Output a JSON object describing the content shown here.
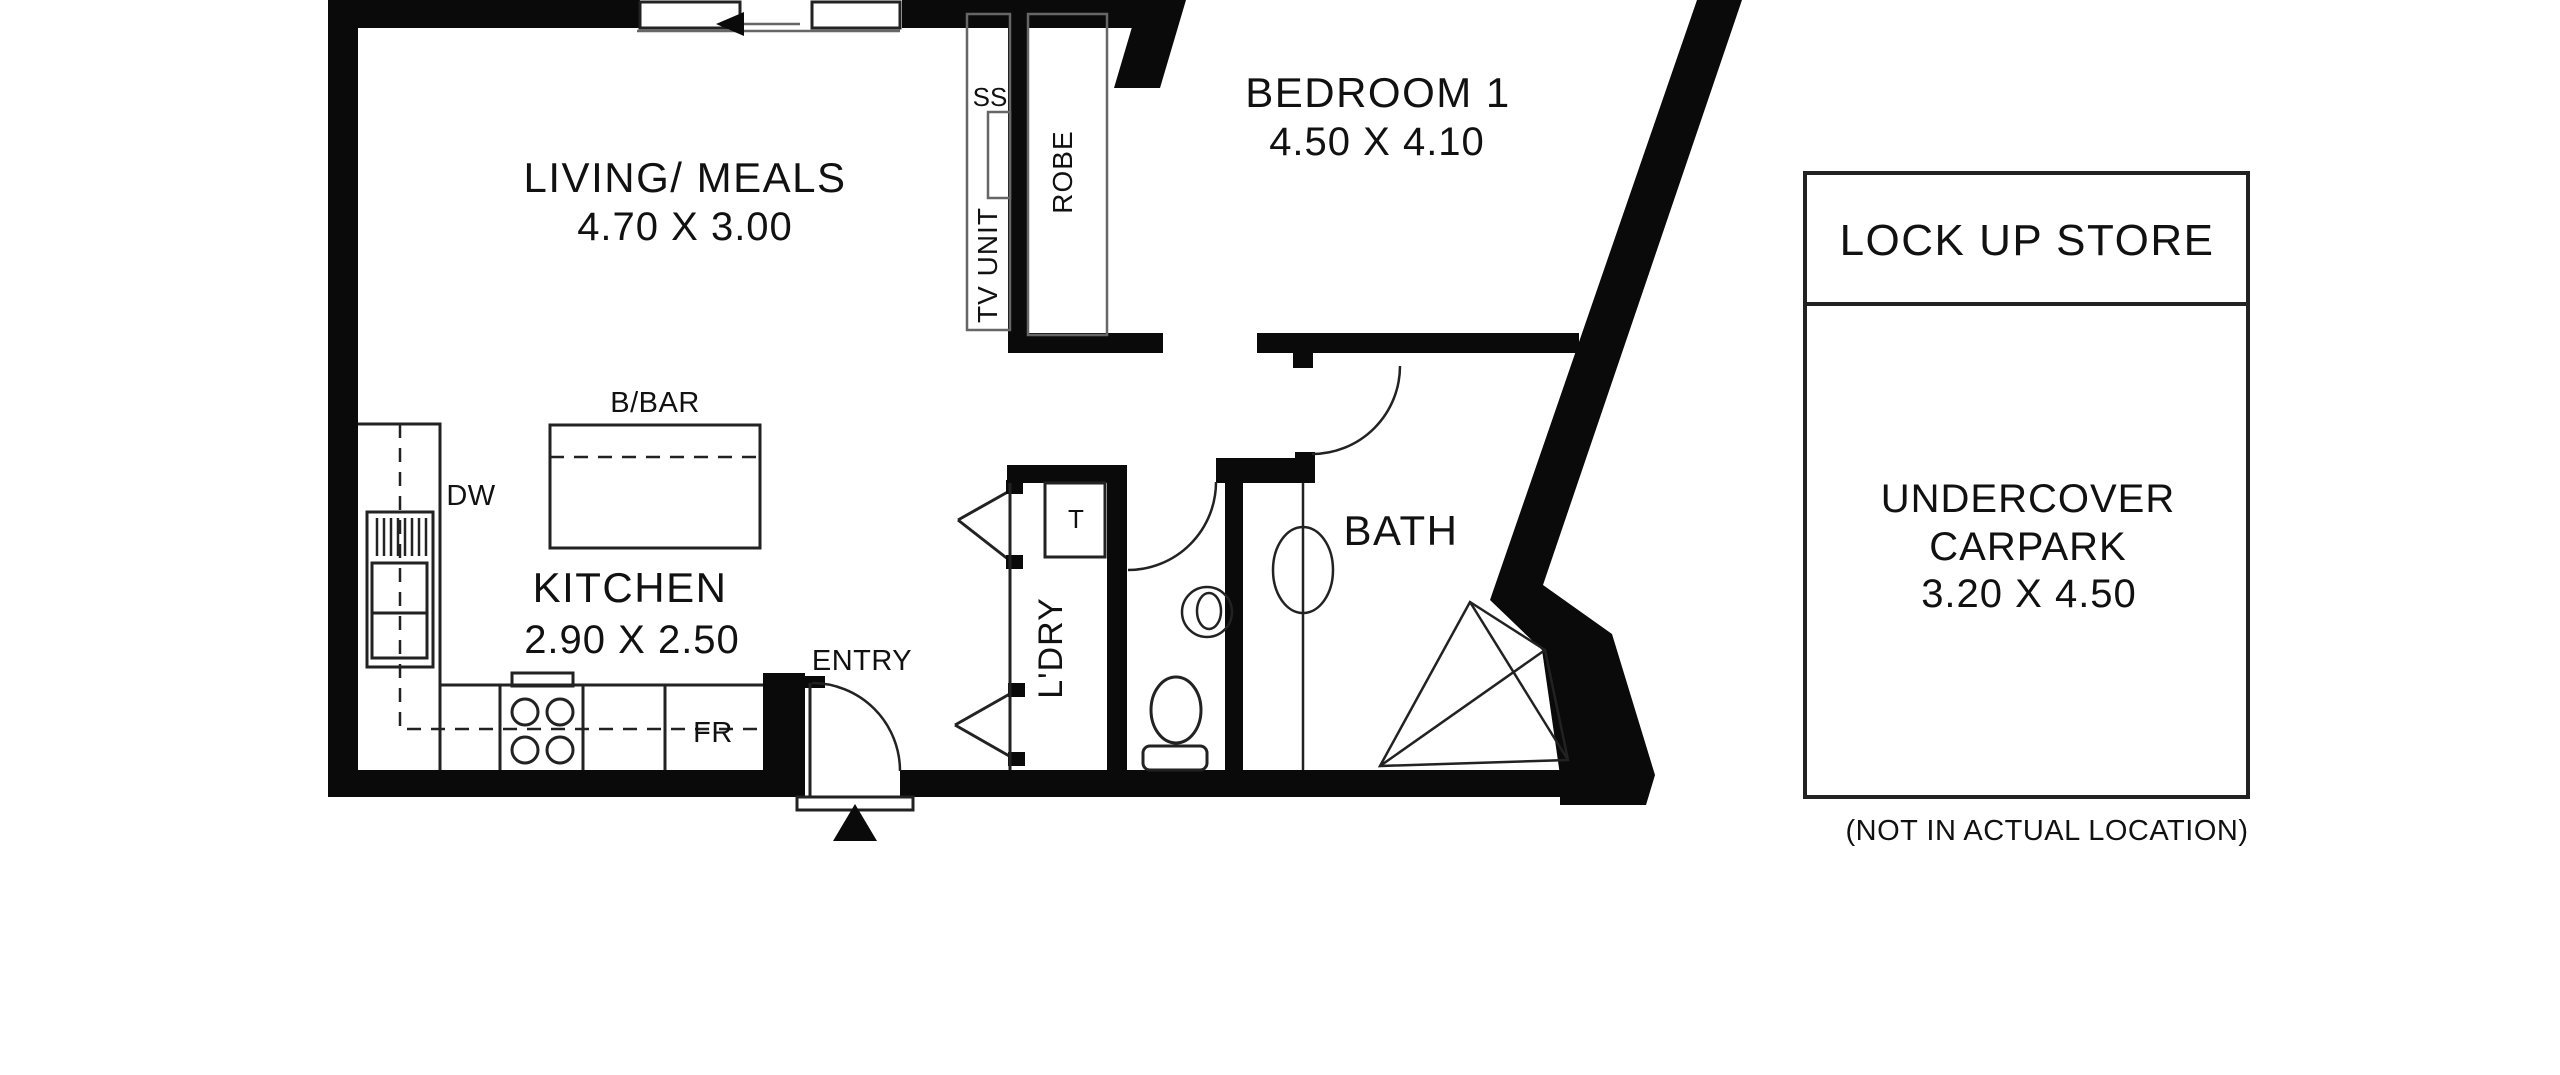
{
  "colors": {
    "background": "#ffffff",
    "walls": "#0a0a0a",
    "lines": "#222222",
    "lightlines": "#666666",
    "text": "#111111"
  },
  "floor_plan": {
    "rooms": {
      "living": {
        "label": "LIVING/ MEALS",
        "dimensions": "4.70 X 3.00"
      },
      "bedroom1": {
        "label": "BEDROOM 1",
        "dimensions": "4.50 X 4.10"
      },
      "kitchen": {
        "label": "KITCHEN",
        "dimensions": "2.90 X 2.50"
      },
      "bath": {
        "label": "BATH"
      },
      "laundry": {
        "label": "L'DRY"
      },
      "entry": {
        "label": "ENTRY"
      }
    },
    "fixtures": {
      "breakfast_bar": "B/BAR",
      "dishwasher": "DW",
      "fridge": "FR",
      "sink": "SS",
      "trough": "T",
      "tv_unit": "TV UNIT",
      "robe": "ROBE"
    }
  },
  "outbuilding": {
    "store_label": "LOCK UP STORE",
    "carpark_line1": "UNDERCOVER",
    "carpark_line2": "CARPARK",
    "carpark_dimensions": "3.20 X 4.50",
    "note": "(NOT IN ACTUAL LOCATION)"
  }
}
